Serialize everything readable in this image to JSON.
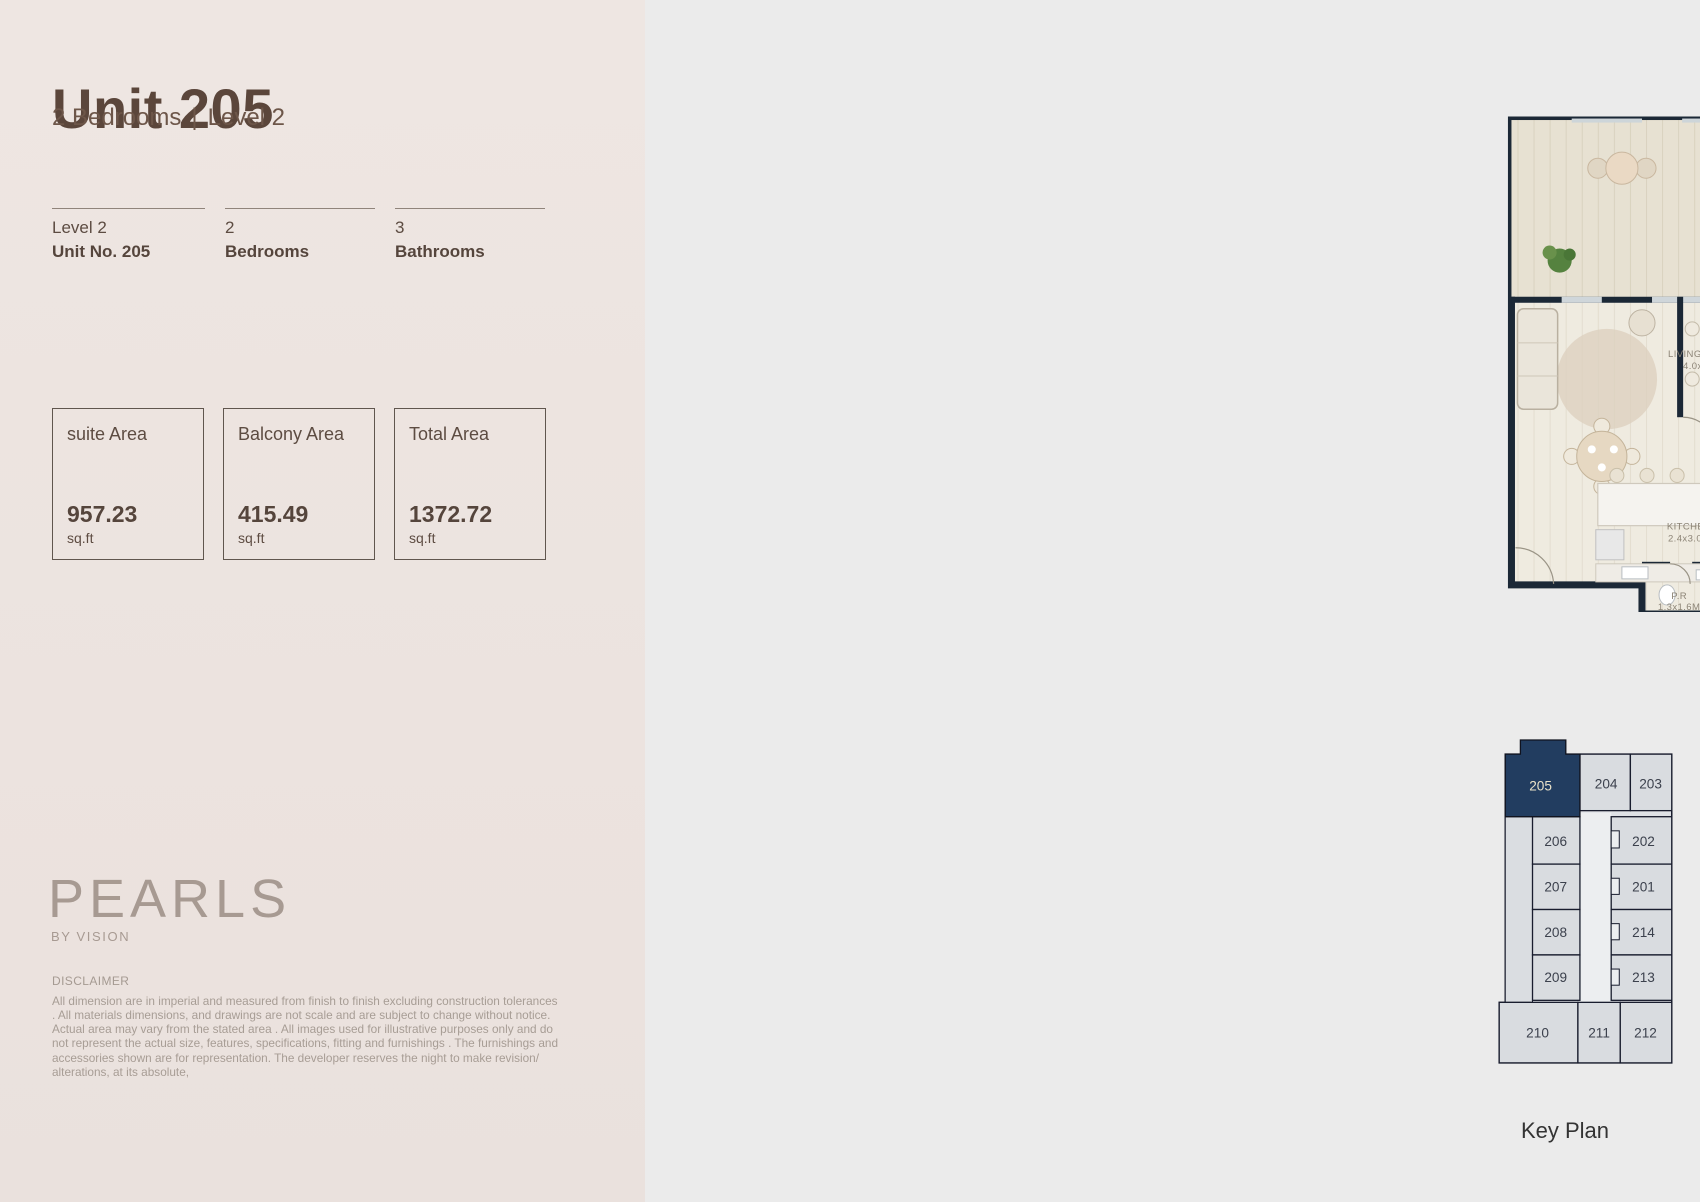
{
  "left_panel": {
    "title": "Unit 205",
    "subtitle_left": "2 Bedrooms",
    "subtitle_sep": "|",
    "subtitle_right": "Level 2",
    "info_columns": [
      {
        "line1": "Level 2",
        "line2": "Unit No. 205"
      },
      {
        "line1": "2",
        "line2": "Bedrooms"
      },
      {
        "line1": "3",
        "line2": "Bathrooms"
      }
    ],
    "area_boxes": [
      {
        "label": "suite Area",
        "value": "957.23",
        "unit": "sq.ft"
      },
      {
        "label": "Balcony Area",
        "value": "415.49",
        "unit": "sq.ft"
      },
      {
        "label": "Total Area",
        "value": "1372.72",
        "unit": "sq.ft"
      }
    ],
    "brand": {
      "name": "PEARLS",
      "tagline": "BY VISION"
    },
    "disclaimer": {
      "heading": "DISCLAIMER",
      "body": "All dimension are in imperial and measured from finish to finish excluding construction tolerances . All materials dimensions, and drawings are not scale and are subject to change without notice. Actual area may vary from the stated area . All images used for illustrative purposes only and do not represent the actual size, features, specifications, fitting and furnishings . The furnishings and accessories shown are for representation. The developer reserves the night to make revision/ alterations, at its absolute,"
    }
  },
  "floor_plan": {
    "rooms": [
      {
        "name": "BALCONY",
        "dims": "1.9X10.0M"
      },
      {
        "name": "LIVING/DINING",
        "dims": "4.0x6.1M"
      },
      {
        "name": "BEDROOM",
        "dims": "3.7X4.0M"
      },
      {
        "name": "BATH.",
        "dims": "1.8X2.4M"
      },
      {
        "name": "BATH.",
        "dims": "1.9X2.4M"
      },
      {
        "name": "BALCONY",
        "dims": "2.4X7.7M"
      },
      {
        "name": "BEDROOM",
        "dims": "3.4x3.6M"
      },
      {
        "name": "LAUNDRY",
        "dims": "1.4x1.9M"
      },
      {
        "name": "KITCHEN",
        "dims": "2.4x3.0M"
      },
      {
        "name": "P.R",
        "dims": "1.3x1.6M"
      }
    ]
  },
  "key_plan": {
    "caption": "Key Plan",
    "highlighted_unit": "205",
    "units": [
      "205",
      "204",
      "203",
      "206",
      "202",
      "207",
      "201",
      "208",
      "214",
      "209",
      "213",
      "210",
      "211",
      "212"
    ]
  },
  "key_elevation": {
    "caption": "Key Elevation"
  },
  "colors": {
    "left_background": "#ece3df",
    "right_background": "#ebebeb",
    "title_brown": "#5b463b",
    "wall_navy": "#1b2836",
    "highlight_unit_navy": "#223d60",
    "elevation_highlight_red": "#d7252b"
  }
}
